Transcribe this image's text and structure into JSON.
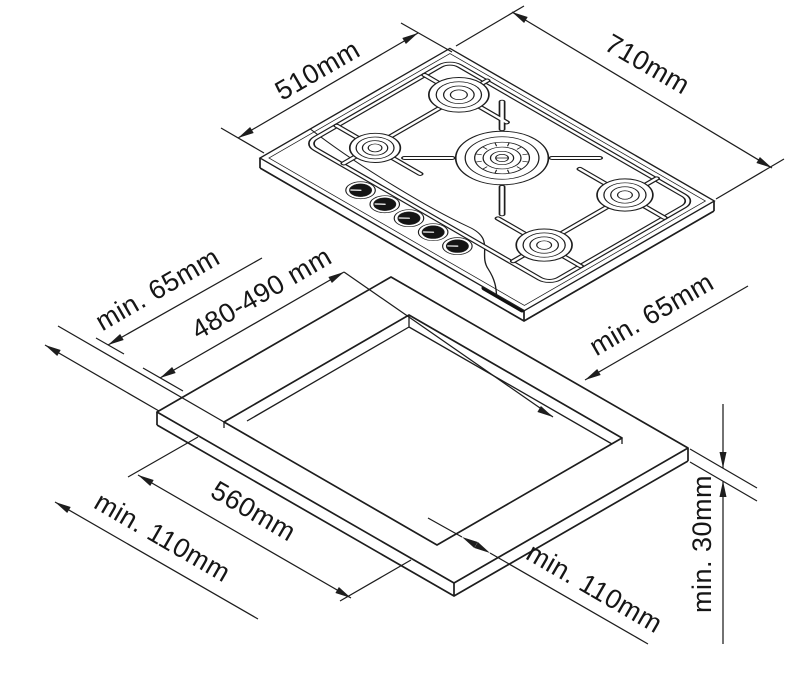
{
  "diagram": {
    "type": "gas-hob-installation-drawing",
    "line_color": "#1d1d1d",
    "background": "#ffffff",
    "hob": {
      "burner_count": 5,
      "knob_count": 5,
      "depth_label": "510mm",
      "width_label": "710mm"
    },
    "installation": {
      "rear_clearance_left": "min. 65mm",
      "cutout_depth": "480-490 mm",
      "rear_clearance_right": "min. 65mm",
      "cutout_width": "560mm",
      "side_clearance_left": "min. 110mm",
      "side_clearance_right": "min. 110mm",
      "worktop_thickness": "min. 30mm"
    }
  }
}
